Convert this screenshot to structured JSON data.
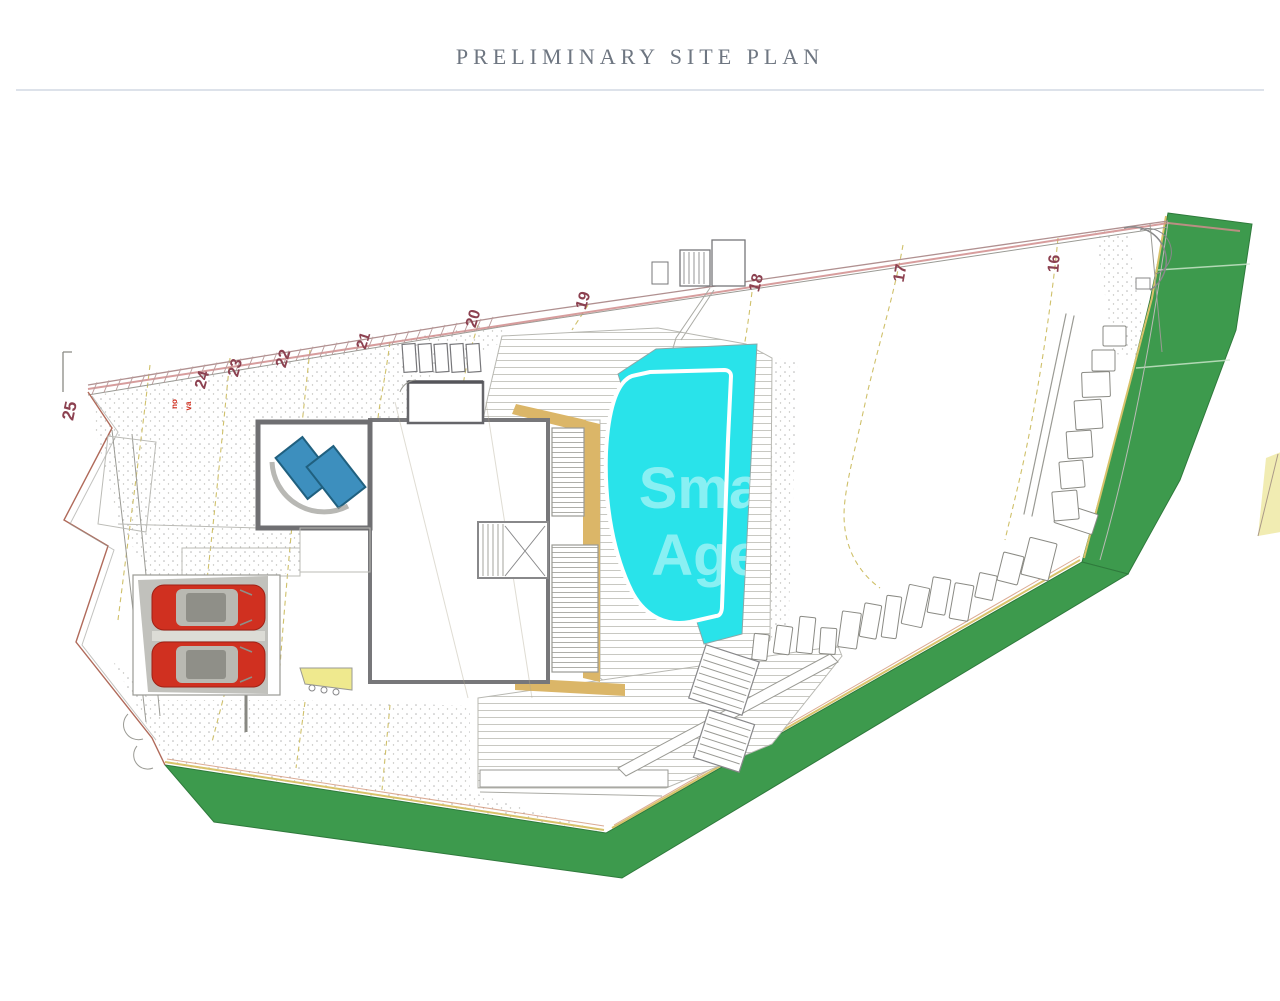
{
  "header": {
    "title": "PRELIMINARY SITE PLAN"
  },
  "plan": {
    "watermark": {
      "line1": "Sma",
      "line2": "Age"
    },
    "contour_labels": [
      {
        "label": "25",
        "x": 75,
        "y": 412,
        "rot": -78,
        "size": 17
      },
      {
        "label": "24",
        "x": 207,
        "y": 381,
        "rot": -75,
        "size": 16
      },
      {
        "label": "23",
        "x": 240,
        "y": 369,
        "rot": -75,
        "size": 16
      },
      {
        "label": "22",
        "x": 288,
        "y": 360,
        "rot": -73,
        "size": 16
      },
      {
        "label": "21",
        "x": 368,
        "y": 342,
        "rot": -73,
        "size": 15
      },
      {
        "label": "20",
        "x": 478,
        "y": 320,
        "rot": -73,
        "size": 16
      },
      {
        "label": "19",
        "x": 588,
        "y": 302,
        "rot": -73,
        "size": 16
      },
      {
        "label": "18",
        "x": 761,
        "y": 284,
        "rot": -75,
        "size": 16
      },
      {
        "label": "17",
        "x": 905,
        "y": 274,
        "rot": -80,
        "size": 16
      },
      {
        "label": "16",
        "x": 1059,
        "y": 264,
        "rot": -85,
        "size": 16
      }
    ],
    "annotations": [
      {
        "text": "no",
        "x": 177,
        "y": 404,
        "rot": -90,
        "size": 8
      },
      {
        "text": "va",
        "x": 191,
        "y": 406,
        "rot": -90,
        "size": 8
      }
    ],
    "colors": {
      "green": "#3d9a4d",
      "pool_cyan": "#29e3ea",
      "deck_tan": "#dbb668",
      "car_red": "#d03020",
      "boundary_pink": "#d08c8c",
      "contour_label": "#8c4150",
      "title_gray": "#6e7681",
      "panel_blue": "#3d8fbe",
      "wedge_yellow": "#efe98e"
    }
  }
}
